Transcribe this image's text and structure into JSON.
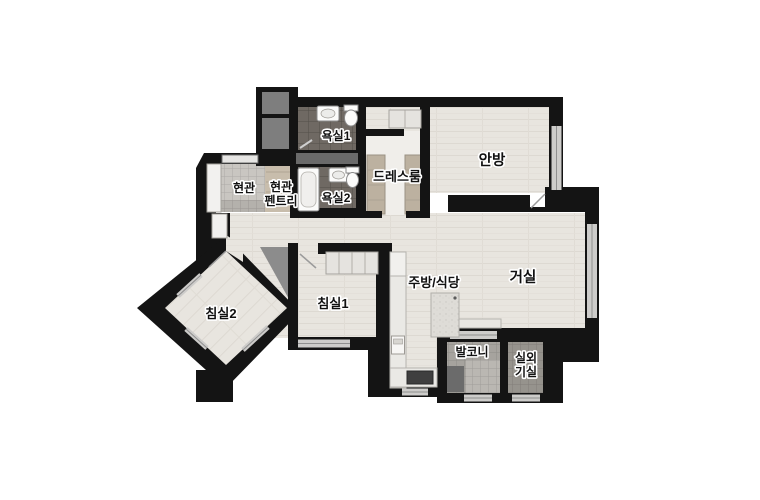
{
  "palette": {
    "wall": "#141414",
    "wood_floor": "#e8e5df",
    "bath_tile": "#6f6963",
    "entry_tile": "#c9c6c1",
    "entry_step": "#b4b1ac",
    "pantry": "#c8bdac",
    "wardrobe": "#bcb1a0",
    "dress_floor": "#f0eeea",
    "balcony_tile": "#a6a39e",
    "balcony_tile_light": "#bab7b2",
    "utility_tile": "#96938d",
    "shaft": "#7e7e7e",
    "wedge": "#8c8c8c",
    "window": "#cdccca",
    "fixture": "#fbfbfa",
    "closet": "#e5e3df",
    "counter": "#eae9e5",
    "appliance": "#3f3f3f",
    "label_fill": "#111111",
    "label_outline": "#ffffff",
    "background": "#ffffff"
  },
  "rooms": {
    "bath1": {
      "label": "욕실1"
    },
    "bath2": {
      "label": "욕실2"
    },
    "entrance": {
      "label": "현관"
    },
    "pantry": {
      "label_line1": "현관",
      "label_line2": "펜트리"
    },
    "dressroom": {
      "label": "드레스룸"
    },
    "master_bedroom": {
      "label": "안방"
    },
    "living_room": {
      "label": "거실"
    },
    "kitchen_dining": {
      "label": "주방/식당"
    },
    "bedroom1": {
      "label": "침실1"
    },
    "bedroom2": {
      "label": "침실2"
    },
    "balcony": {
      "label": "발코니"
    },
    "outdoor_unit": {
      "label_line1": "실외",
      "label_line2": "기실"
    }
  }
}
